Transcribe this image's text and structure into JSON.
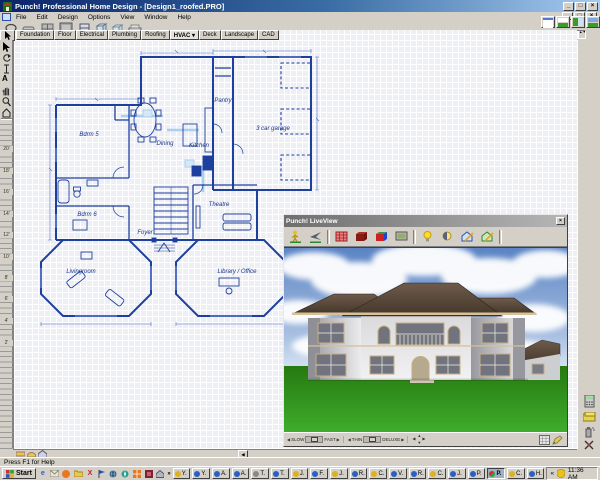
{
  "titlebar": {
    "title": "Punch! Professional Home Design - [Design1_roofed.PRO]"
  },
  "window_controls": {
    "minimize": "_",
    "restore": "□",
    "close": "×"
  },
  "menu": {
    "items": [
      "File",
      "Edit",
      "Design",
      "Options",
      "View",
      "Window",
      "Help"
    ]
  },
  "tabs": {
    "items": [
      "Foundation",
      "Floor",
      "Electrical",
      "Plumbing",
      "Roofing",
      "HVAC",
      "Deck",
      "Landscape",
      "CAD"
    ],
    "active": "HVAC",
    "caret": "▾"
  },
  "ruler": {
    "labels": [
      "20'",
      "18'",
      "16'",
      "14'",
      "12'",
      "10'",
      "8'",
      "6'",
      "4'",
      "2'"
    ]
  },
  "plan": {
    "rooms": {
      "bdrm5": "Bdrm 5",
      "dining": "Dining",
      "kitchen": "Kitchen",
      "pantry": "Pantry",
      "garage": "3 car garage",
      "bdrm6": "Bdrm 6",
      "theatre": "Theatre",
      "foyer": "Foyer",
      "livingroom": "Livingroom",
      "library": "Library / Office"
    }
  },
  "liveview": {
    "title": "Punch! LiveView",
    "speed_min": "SLOW",
    "speed_max": "FAST",
    "detail_min": "THIN",
    "detail_max": "DELUXE"
  },
  "statusbar": {
    "help_text": "Press F1 for Help"
  },
  "taskbar": {
    "start": "Start",
    "overflow": "»",
    "buttons": [
      "Y.",
      "Y.",
      "A.",
      "A.",
      "T.",
      "T.",
      "J.",
      "F.",
      "J.",
      "R.",
      "C.",
      "V.",
      "R.",
      "C.",
      "J.",
      "P.",
      "P.",
      "C.",
      "H."
    ],
    "active_button_index": 16,
    "tray_chevron": "«",
    "clock": "11:36 AM"
  },
  "icons": {
    "main_toolbar": [
      "lasso-select-icon",
      "tape-measure-icon",
      "grid-icon",
      "panel-icon",
      "cabinet-icon",
      "cube-icon",
      "cube-alt-icon",
      "drawer-icon"
    ],
    "view_modes": [
      "plan-view-icon",
      "split-view-icon",
      "elevation-view-icon",
      "3d-view-icon"
    ],
    "left_tools": [
      "pointer-icon",
      "rotate-icon",
      "ibeam-icon",
      "text-icon",
      "pan-hand-icon",
      "zoom-icon",
      "house-icon"
    ],
    "liveview_toolbar": [
      "walk-icon",
      "fly-icon",
      "wireframe-box-icon",
      "solid-box-icon",
      "textured-box-icon",
      "screen-icon",
      "light-icon",
      "day-night-icon",
      "edit-house-blue-icon",
      "edit-house-green-icon"
    ],
    "right_tools": [
      "calculator-icon",
      "materials-box-icon",
      "spray-icon",
      "cut-icon"
    ],
    "quick_launch": [
      "ie-icon",
      "mail-icon",
      "ball-icon",
      "folder-icon",
      "media-icon",
      "flag-icon",
      "globe-icon",
      "compass-icon",
      "orange-grid-icon",
      "maroon-icon",
      "home-icon"
    ]
  },
  "colors": {
    "blueprint_blue": "#1d3f9e",
    "hvac_cyan": "#9ccaee",
    "titlebar_blue": "#0a246a",
    "chrome_gray": "#d4d0c8",
    "grass_green": "#2e8b22",
    "sky_blue": "#5b84c4",
    "roof_brown": "#5d4a38"
  }
}
